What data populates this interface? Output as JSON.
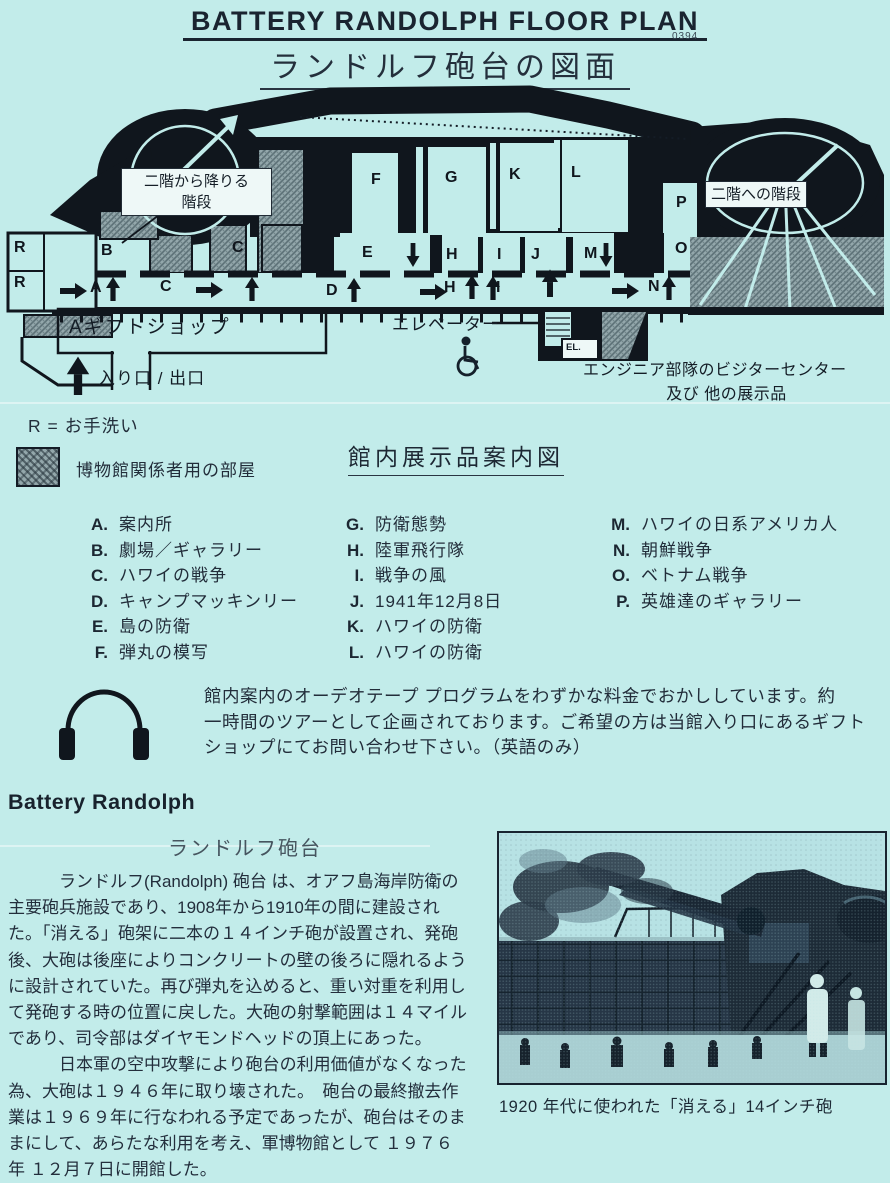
{
  "page": {
    "title_en": "BATTERY RANDOLPH FLOOR PLAN",
    "doc_number": "0394",
    "title_ja": "ランドルフ砲台の図面"
  },
  "floor_plan": {
    "letters": [
      {
        "t": "R",
        "x": 14,
        "y": 155
      },
      {
        "t": "R",
        "x": 14,
        "y": 190
      },
      {
        "t": "B",
        "x": 101,
        "y": 158
      },
      {
        "t": "C",
        "x": 232,
        "y": 155
      },
      {
        "t": "F",
        "x": 371,
        "y": 87
      },
      {
        "t": "G",
        "x": 445,
        "y": 85
      },
      {
        "t": "K",
        "x": 509,
        "y": 82
      },
      {
        "t": "L",
        "x": 571,
        "y": 80
      },
      {
        "t": "P",
        "x": 676,
        "y": 110
      },
      {
        "t": "E",
        "x": 362,
        "y": 160
      },
      {
        "t": "H",
        "x": 446,
        "y": 162
      },
      {
        "t": "I",
        "x": 497,
        "y": 162
      },
      {
        "t": "J",
        "x": 531,
        "y": 162
      },
      {
        "t": "M",
        "x": 584,
        "y": 161
      },
      {
        "t": "O",
        "x": 675,
        "y": 156
      },
      {
        "t": "A",
        "x": 90,
        "y": 195
      },
      {
        "t": "C",
        "x": 160,
        "y": 194
      },
      {
        "t": "D",
        "x": 326,
        "y": 198
      },
      {
        "t": "H",
        "x": 444,
        "y": 195
      },
      {
        "t": "I",
        "x": 496,
        "y": 195
      },
      {
        "t": "N",
        "x": 648,
        "y": 194
      }
    ],
    "labels": {
      "stairs_down_1": "二階から降りる",
      "stairs_down_2": "階段",
      "stairs_up": "二階への階段",
      "gift_shop": "Aギフトショップ",
      "elevator": "エレベーター",
      "el_box": "EL.",
      "entrance": "入り口 / 出口",
      "engineer_1": "エンジニア部隊のビジターセンター",
      "engineer_2": "及び 他の展示品"
    }
  },
  "legend": {
    "restroom": "R = お手洗い",
    "staff_room": "博物館関係者用の部屋",
    "guide_title": "館内展示品案内図"
  },
  "exhibits": {
    "col1": [
      {
        "key": "A.",
        "label": "案内所"
      },
      {
        "key": "B.",
        "label": "劇場／ギャラリー"
      },
      {
        "key": "C.",
        "label": "ハワイの戦争"
      },
      {
        "key": "D.",
        "label": "キャンプマッキンリー"
      },
      {
        "key": "E.",
        "label": "島の防衛"
      },
      {
        "key": "F.",
        "label": "弾丸の模写"
      }
    ],
    "col2": [
      {
        "key": "G.",
        "label": "防衛態勢"
      },
      {
        "key": "H.",
        "label": "陸軍飛行隊"
      },
      {
        "key": "I.",
        "label": "戦争の風"
      },
      {
        "key": "J.",
        "label": "1941年12月8日"
      },
      {
        "key": "K.",
        "label": "ハワイの防衛"
      },
      {
        "key": "L.",
        "label": "ハワイの防衛"
      }
    ],
    "col3": [
      {
        "key": "M.",
        "label": "ハワイの日系アメリカ人"
      },
      {
        "key": "N.",
        "label": "朝鮮戦争"
      },
      {
        "key": "O.",
        "label": "ベトナム戦争"
      },
      {
        "key": "P.",
        "label": "英雄達のギャラリー"
      }
    ]
  },
  "audio_note": {
    "line1": "館内案内のオーデオテープ プログラムをわずかな料金でおかししています。約",
    "line2": "一時間のツアーとして企画されております。ご希望の方は当館入り口にあるギフト",
    "line3": "ショップにてお問い合わせ下さい。（英語のみ）"
  },
  "battery_section": {
    "heading_en": "Battery Randolph",
    "heading_ja": "ランドルフ砲台",
    "para1": [
      "　　　ランドルフ(Randolph) 砲台 は、オアフ島海岸防衛の",
      "主要砲兵施設であり、1908年から1910年の間に建設され",
      "た。「消える」砲架に二本の１４インチ砲が設置され、発砲",
      "後、大砲は後座によりコンクリートの壁の後ろに隠れるよう",
      "に設計されていた。再び弾丸を込めると、重い対重を利用し",
      "て発砲する時の位置に戻した。大砲の射撃範囲は１４マイル",
      "であり、司令部はダイヤモンドヘッドの頂上にあった。"
    ],
    "para2": [
      "　　　日本軍の空中攻撃により砲台の利用価値がなくなった",
      "為、大砲は１９４６年に取り壊された。　砲台の最終撤去作",
      "業は１９６９年に行なわれる予定であったが、砲台はそのま",
      "まにして、あらたな利用を考え、軍博物館として １９７６",
      "年 １２月７日に開館した。"
    ],
    "photo_caption": "1920 年代に使われた「消える」14インチ砲"
  }
}
